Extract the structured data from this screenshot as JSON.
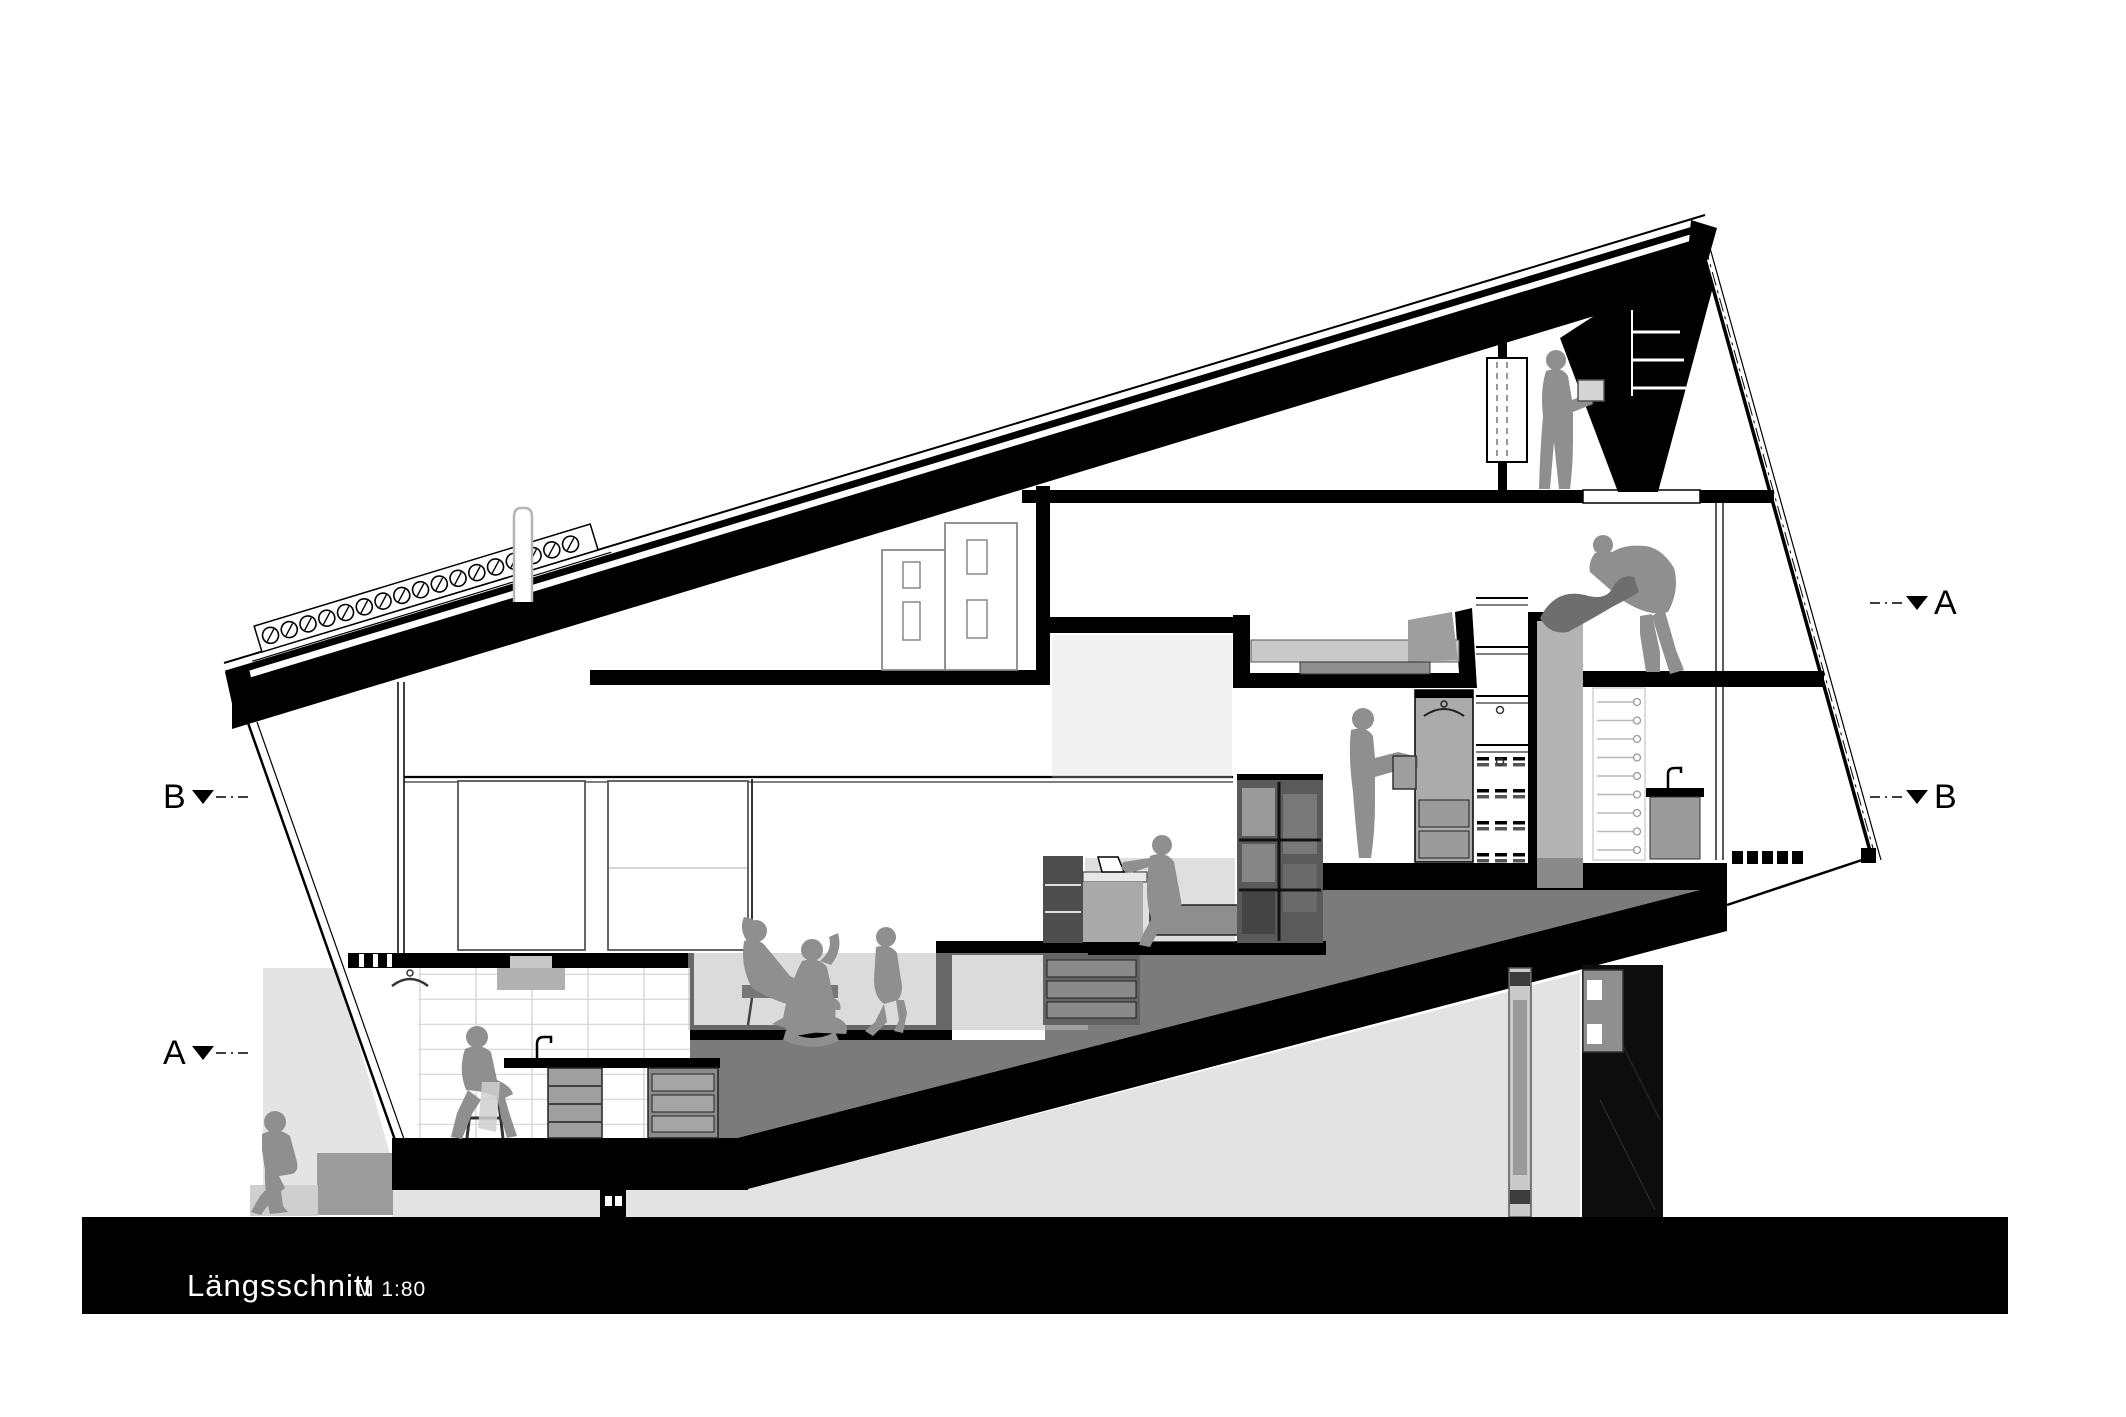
{
  "title_block": {
    "title": "Längsschnitt",
    "scale": "M 1:80",
    "bar_color": "#000000",
    "text_color": "#ffffff"
  },
  "section_markers": {
    "left_top": {
      "label": "B"
    },
    "left_bottom": {
      "label": "A"
    },
    "right_top": {
      "label": "A"
    },
    "right_bottom": {
      "label": "B"
    }
  },
  "drawing": {
    "type": "architectural-longitudinal-section",
    "colors": {
      "cut_black": "#000000",
      "step_mass_gray": "#7b7b7b",
      "figure_gray": "#8f8f8f",
      "glass_tint": "#bdbdbd",
      "terrain_light_gray": "#e3e3e3",
      "furniture_gray": "#9b9b9b",
      "dark_room": "#0d0d0d"
    },
    "generated": {
      "skylight_circles": 17,
      "stair_tread_line_pairs": 4,
      "stair_hidden_dash_rows": 4,
      "shelf_pin_rows": 9,
      "slab_end_dashes": 5
    },
    "figures": [
      "person-sitting-on-steps-outside",
      "person-sitting-on-stool-kitchen",
      "person-reclining-lounge",
      "person-sitting-cross-legged",
      "person-stepping-down-living",
      "person-working-on-laptop",
      "person-standing-with-box",
      "person-making-bed",
      "person-standing-attic-with-box"
    ]
  }
}
